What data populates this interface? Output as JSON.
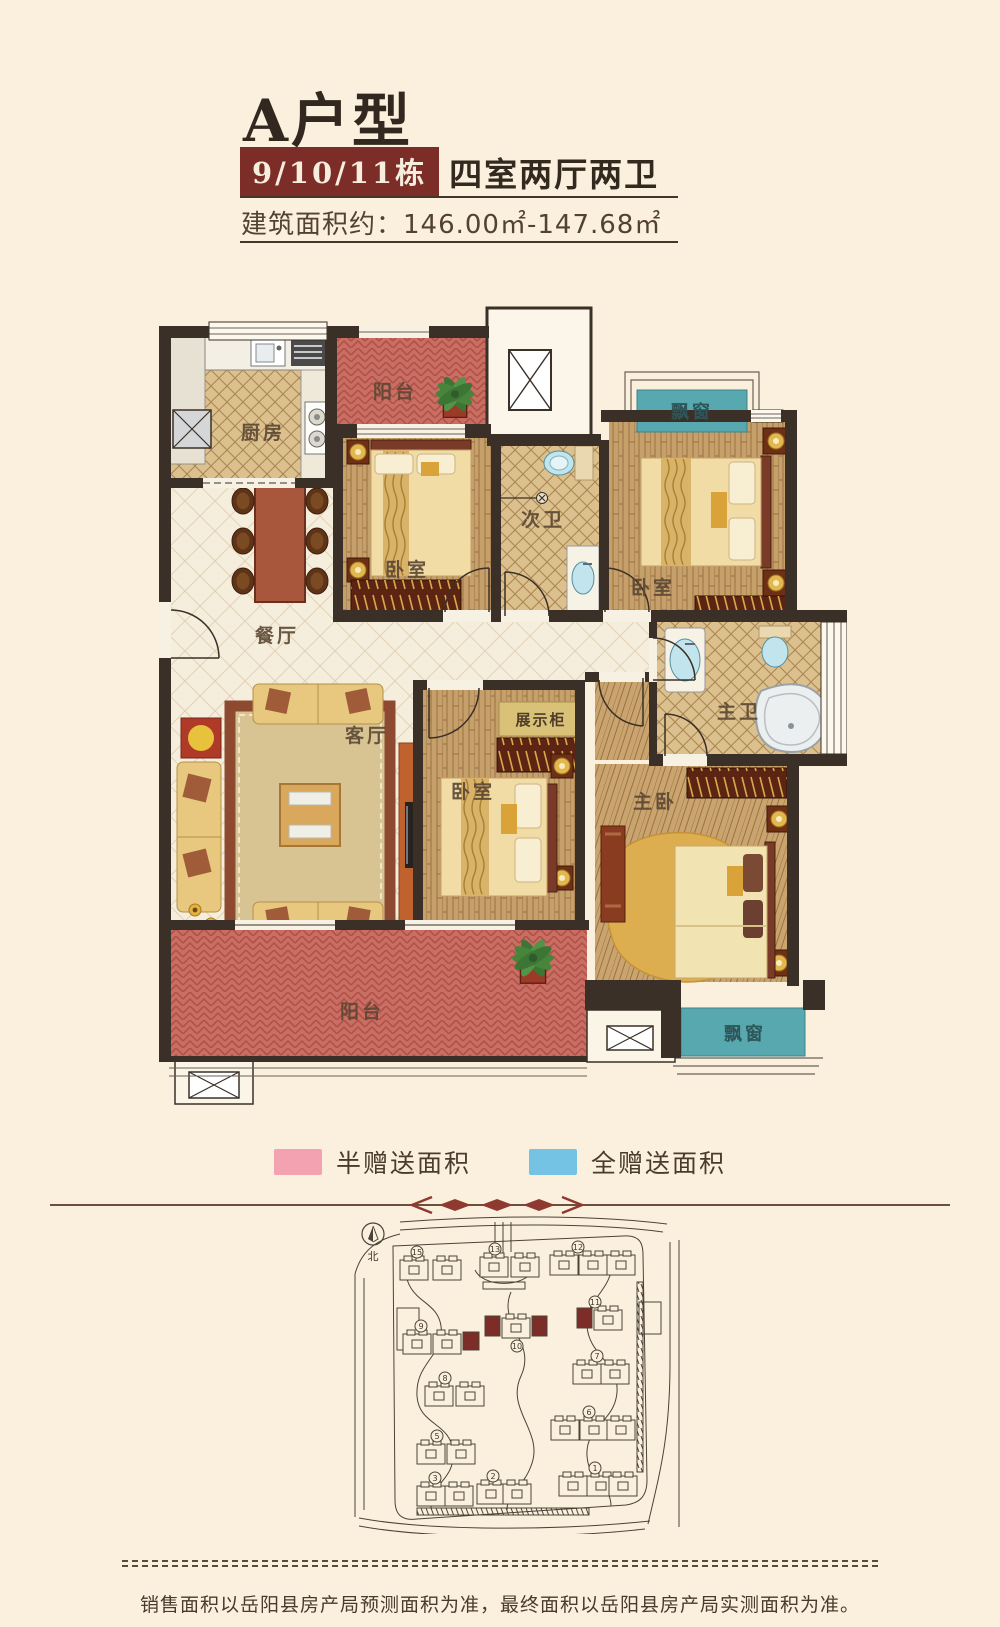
{
  "page": {
    "background": "#faf0dd"
  },
  "header": {
    "title": "A户型",
    "badge": "9/10/11栋",
    "layout_text": "四室两厅两卫",
    "area_text": "建筑面积约：146.00㎡-147.68㎡",
    "accent_color": "#7c2d27"
  },
  "floorplan": {
    "rooms": {
      "kitchen": "厨房",
      "balcony_top": "阳台",
      "bedroom_top_left": "卧室",
      "bath_secondary": "次卫",
      "bedroom_top_right": "卧室",
      "bay_window_top": "飘窗",
      "dining": "餐厅",
      "living": "客厅",
      "display_cabinet": "展示柜",
      "bedroom_center": "卧室",
      "bath_master": "主卫",
      "bedroom_master": "主卧",
      "balcony_bottom": "阳台",
      "bay_window_bottom": "飘窗"
    },
    "colors": {
      "wall": "#3a3027",
      "half_gift_area": "#c96e63",
      "full_gift_area": "#57a9af"
    }
  },
  "legend": {
    "items": [
      {
        "label": "半赠送面积",
        "color": "#f2a2b1"
      },
      {
        "label": "全赠送面积",
        "color": "#74c2e4"
      }
    ]
  },
  "siteplan": {
    "north_label": "北",
    "buildings": [
      {
        "num": "15",
        "highlight": false
      },
      {
        "num": "13",
        "highlight": false
      },
      {
        "num": "12",
        "highlight": false
      },
      {
        "num": "9",
        "highlight": true
      },
      {
        "num": "10",
        "highlight": true
      },
      {
        "num": "11",
        "highlight": true
      },
      {
        "num": "8",
        "highlight": false
      },
      {
        "num": "7",
        "highlight": false
      },
      {
        "num": "5",
        "highlight": false
      },
      {
        "num": "6",
        "highlight": false
      },
      {
        "num": "3",
        "highlight": false
      },
      {
        "num": "2",
        "highlight": false
      },
      {
        "num": "1",
        "highlight": false
      }
    ]
  },
  "footer": {
    "note": "销售面积以岳阳县房产局预测面积为准，最终面积以岳阳县房产局实测面积为准。"
  }
}
